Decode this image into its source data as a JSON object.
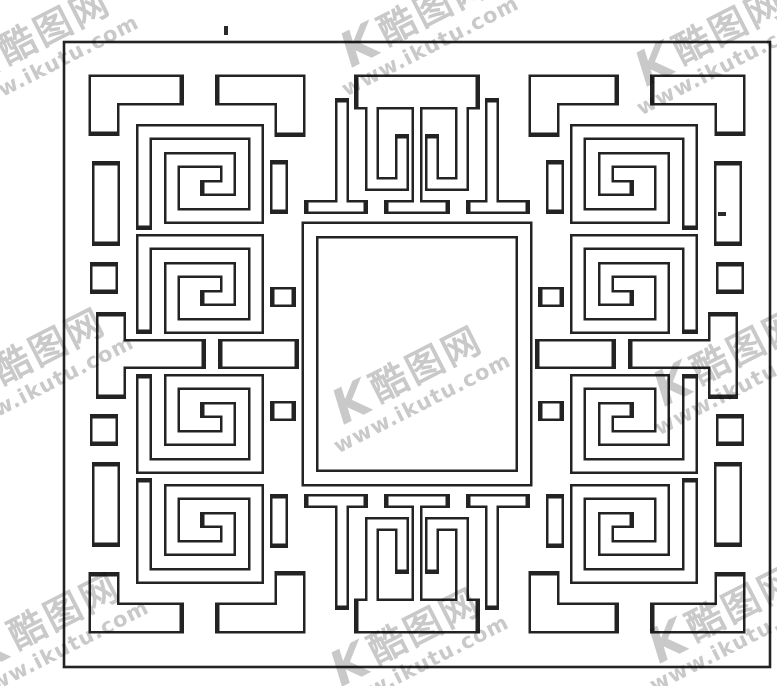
{
  "image": {
    "subject": "Chinese lattice fretwork panel — scanned line drawing",
    "style": "black outline meander (hui-wen) pattern with empty central square"
  },
  "watermark": {
    "logo_mark": "K",
    "site_name": "酷图网",
    "site_url": "www.ikutu.com",
    "tile_count": 9,
    "color": "#c5c5c5"
  },
  "colors": {
    "background": "#ffffff",
    "line_color": "#232323"
  }
}
